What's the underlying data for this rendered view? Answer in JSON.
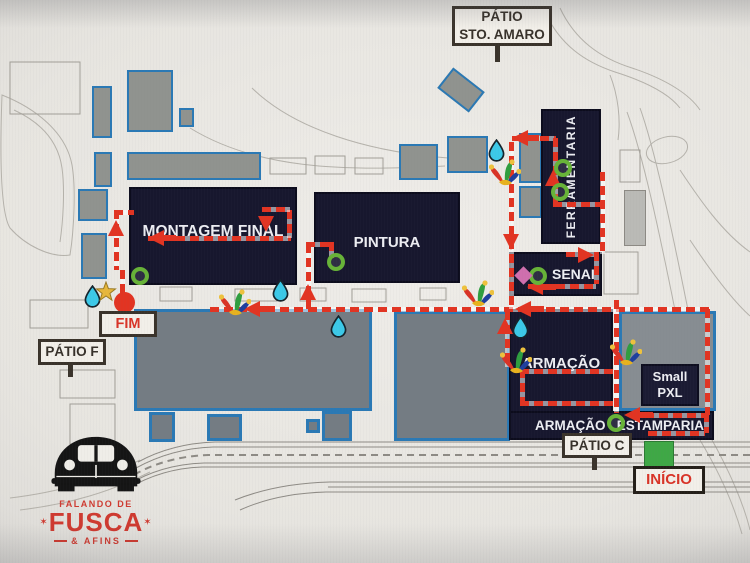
{
  "labels": {
    "patio_sto_amaro": {
      "line1": "PÁTIO",
      "line2": "STO. AMARO"
    },
    "fim": "FIM",
    "patio_f": "PÁTIO F",
    "patio_c": "PÁTIO C",
    "inicio": "INÍCIO"
  },
  "buildings": {
    "montagem_final": "MONTAGEM FINAL",
    "pintura": "PINTURA",
    "ferramentaria": "FERRAMENTARIA",
    "senai": "SENAI",
    "armacao": "ARMAÇÃO",
    "armacao_strip": "ARMAÇÃO",
    "estamparia": "ESTAMPARIA",
    "small_pxl": {
      "line1": "Small",
      "line2": "PXL"
    }
  },
  "logo": {
    "top": "FALANDO DE",
    "main": "FUSCA",
    "bottom": "& AFINS",
    "star": "✶"
  },
  "route": {
    "style": "dashed",
    "color": "#e23422",
    "start_label": "INÍCIO",
    "end_label": "FIM"
  },
  "markers": {
    "start_square_color": "#3fa846",
    "end_circle_color": "#e23422",
    "water_drop_color": "#3cc9e8",
    "checkpoint_ring_color": "#67b338",
    "star_color": "#e7b73c",
    "diamond_color": "#cf6fae",
    "counts": {
      "water_drops": 5,
      "jester_hats": 5,
      "checkpoint_rings": 6
    }
  },
  "colors": {
    "building_dark": "#17172e",
    "building_gray": "#90938f",
    "slab_gray": "#747c83",
    "border_blue": "#2a79b5",
    "map_bg": "#e9e7e2",
    "label_border": "#3a332b",
    "label_text": "#37312a",
    "red_text": "#d93327",
    "logo_red": "#cf3a30"
  }
}
